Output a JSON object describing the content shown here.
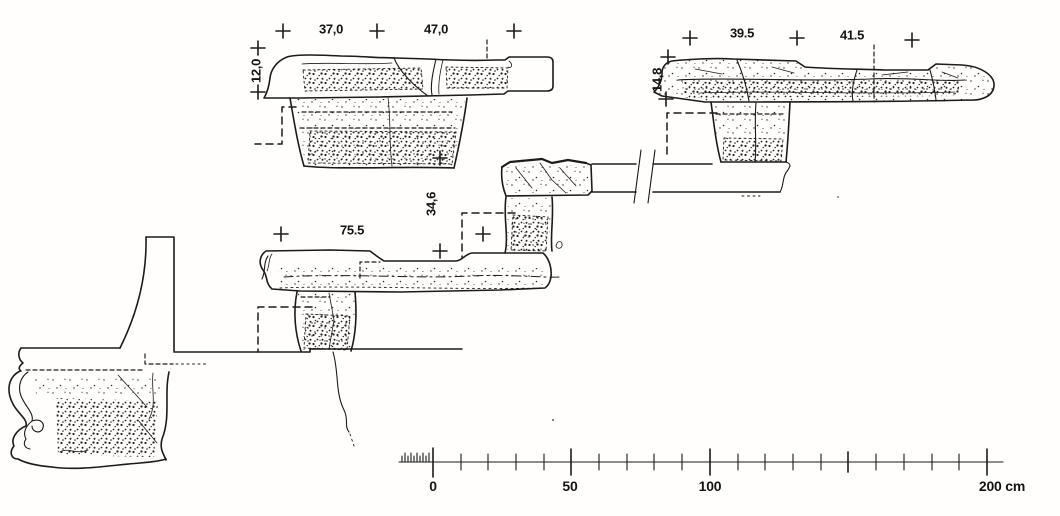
{
  "figure": {
    "description": "Measured section drawing of four stepped stone seat and step profiles with survey cross marks and a metric scale bar",
    "unit": "cm"
  },
  "labels": {
    "d37": "37,0",
    "d47": "47,0",
    "d12": "12,0",
    "d395": "39.5",
    "d415": "41.5",
    "d148": "14,8",
    "d755": "75.5",
    "d346": "34,6"
  },
  "scale": {
    "t0": "0",
    "t50": "50",
    "t100": "100",
    "t200": "200 cm"
  },
  "measurements": {
    "upper_left_profile": {
      "tread_widths_cm": [
        37.0,
        47.0
      ],
      "riser_height_cm": 12.0
    },
    "upper_right_profile": {
      "tread_widths_cm": [
        39.5,
        41.5
      ],
      "riser_height_cm": 14.8
    },
    "middle_profile": {
      "tread_width_cm": 75.5,
      "riser_height_cm": 34.6
    },
    "scale_bar_range_cm": [
      0,
      200
    ]
  }
}
